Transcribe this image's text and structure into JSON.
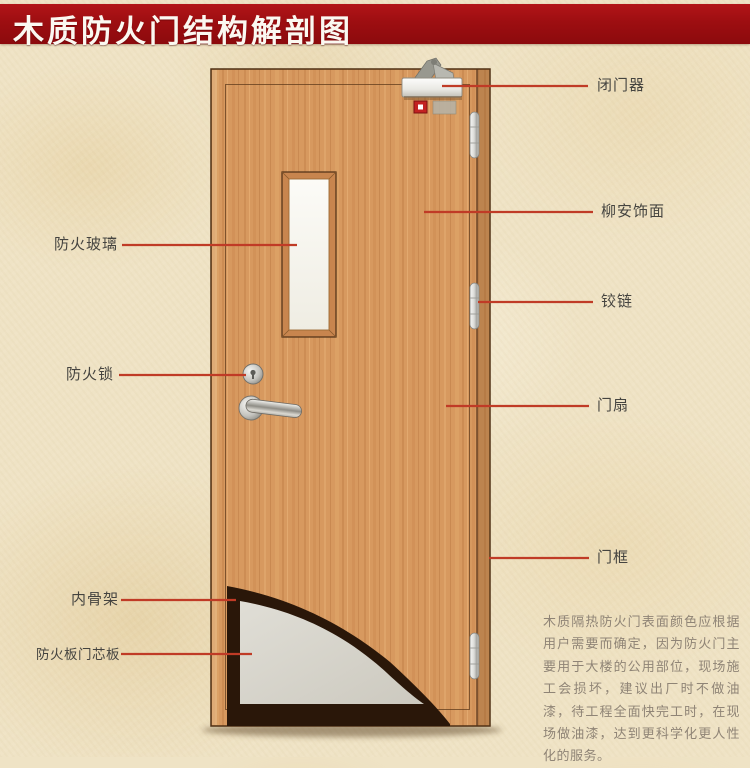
{
  "title": "木质防火门结构解剖图",
  "left_labels": [
    {
      "id": "fire-glass",
      "text": "防火玻璃"
    },
    {
      "id": "fire-lock",
      "text": "防火锁"
    },
    {
      "id": "inner-skeleton",
      "text": "内骨架"
    },
    {
      "id": "core-board",
      "text": "防火板门芯板"
    }
  ],
  "right_labels": [
    {
      "id": "door-closer",
      "text": "闭门器"
    },
    {
      "id": "lauan-veneer",
      "text": "柳安饰面"
    },
    {
      "id": "hinge",
      "text": "铰链"
    },
    {
      "id": "door-leaf",
      "text": "门扇"
    },
    {
      "id": "door-frame",
      "text": "门框"
    }
  ],
  "description": "木质隔热防火门表面颜色应根据用户需要而确定，因为防火门主要用于大楼的公用部位，现场施工会损坏，建议出厂时不做油漆，待工程全面快完工时，在现场做油漆，达到更科学化更人性化的服务。",
  "colors": {
    "banner_red": "#9d0e11",
    "leader_line": "#c03b26",
    "wood": "#d7995f",
    "label_text": "#454440",
    "description_text": "#8f8476",
    "background": "#efe3c5",
    "core_gray": "#d8d6cd",
    "skeleton_dark": "#2a1709"
  }
}
